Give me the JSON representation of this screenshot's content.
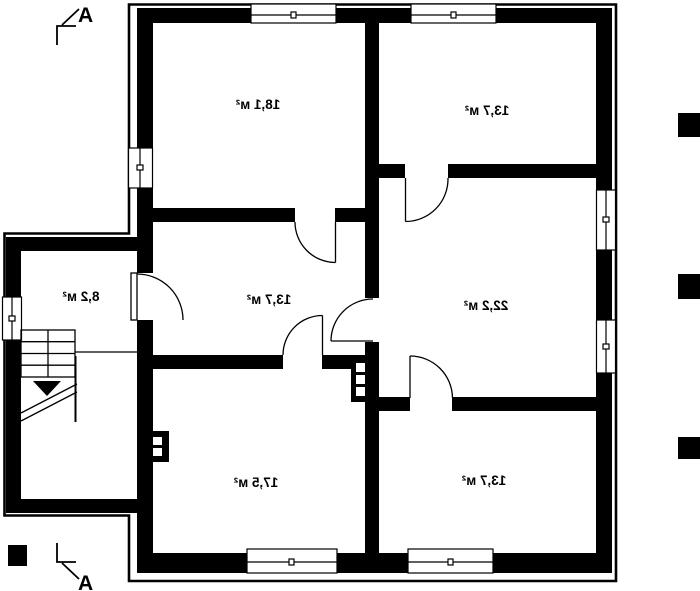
{
  "document": {
    "type": "architectural floor plan",
    "note_text_orientation": "room area labels are rendered mirrored (flipped horizontally)"
  },
  "colors": {
    "walls": "#000000",
    "background": "#ffffff"
  },
  "rooms": [
    {
      "id": "room-top-left",
      "label": "18,1 м²"
    },
    {
      "id": "room-top-right",
      "label": "13,7 м²"
    },
    {
      "id": "room-annex",
      "label": "8,2 м²"
    },
    {
      "id": "room-hallway",
      "label": "13,7 м²"
    },
    {
      "id": "room-middle-right",
      "label": "22,2 м²"
    },
    {
      "id": "room-bottom-left",
      "label": "17,5 м²"
    },
    {
      "id": "room-bottom-right",
      "label": "13,7 м²"
    }
  ],
  "section_marks": {
    "top_label": "A",
    "bottom_label": "A"
  }
}
